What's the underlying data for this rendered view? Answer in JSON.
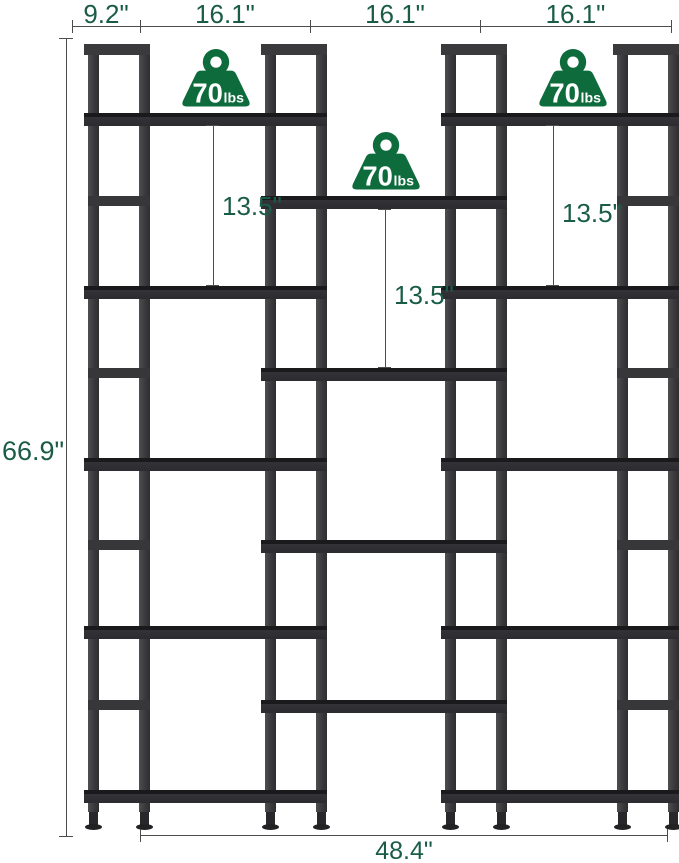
{
  "diagram": {
    "product": "triple-wide staggered bookshelf dimension diagram",
    "top_dimensions": {
      "depth": "9.2\"",
      "column_widths": [
        "16.1\"",
        "16.1\"",
        "16.1\""
      ]
    },
    "overall_height": "66.9\"",
    "overall_width": "48.4\"",
    "shelf_spacing": {
      "left": "13.5\"",
      "middle": "13.5\"",
      "right": "13.5\""
    },
    "weight_capacity": {
      "value": "70",
      "unit": "lbs"
    },
    "colors": {
      "frame": "#3a3a3d",
      "shelf": "#2c2c30",
      "badge_green": "#0e6c3c",
      "dimension_text": "#1a5c48",
      "dimension_line": "#4c4c4c"
    }
  }
}
